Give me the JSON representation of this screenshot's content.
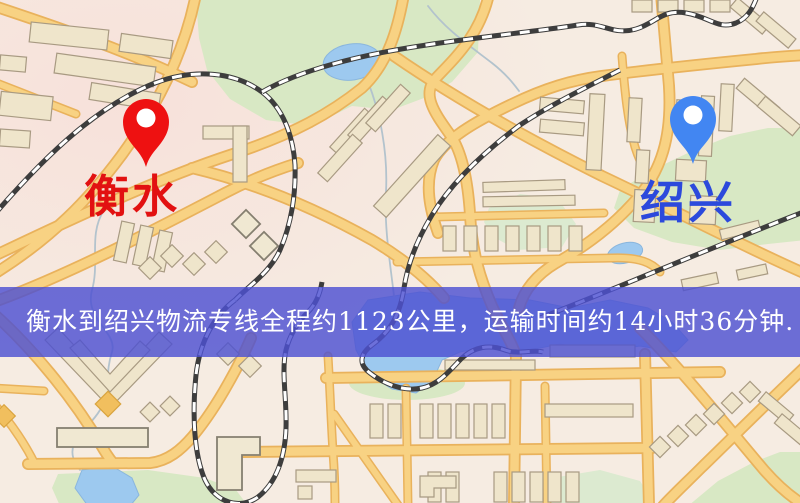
{
  "banner": {
    "text": "衡水到绍兴物流专线全程约1123公里，运输时间约14小时36分钟.",
    "background_color": "#4d51d2",
    "text_color": "#ffffff"
  },
  "markers": {
    "origin": {
      "label": "衡水",
      "pin_color": "#ee1111",
      "inner_dot_color": "#ffffff",
      "label_color": "#e21111"
    },
    "destination": {
      "label": "绍兴",
      "pin_color": "#4286f2",
      "inner_dot_color": "#ffffff",
      "label_color": "#2c49dc"
    }
  },
  "map_palette": {
    "background": "#f6ece2",
    "background_tint": "#f8dcda",
    "road_fill": "#f8d283",
    "road_casing": "#e9b25c",
    "building_fill": "#efe5cb",
    "building_stroke": "#a89a82",
    "park": "#d8e8c4",
    "water": "#9dc9ef",
    "railway_dark": "#3d3d3d",
    "railway_light": "#ffffff",
    "stream": "#b3c3cd",
    "poi_orange": "#f1bf5e"
  }
}
